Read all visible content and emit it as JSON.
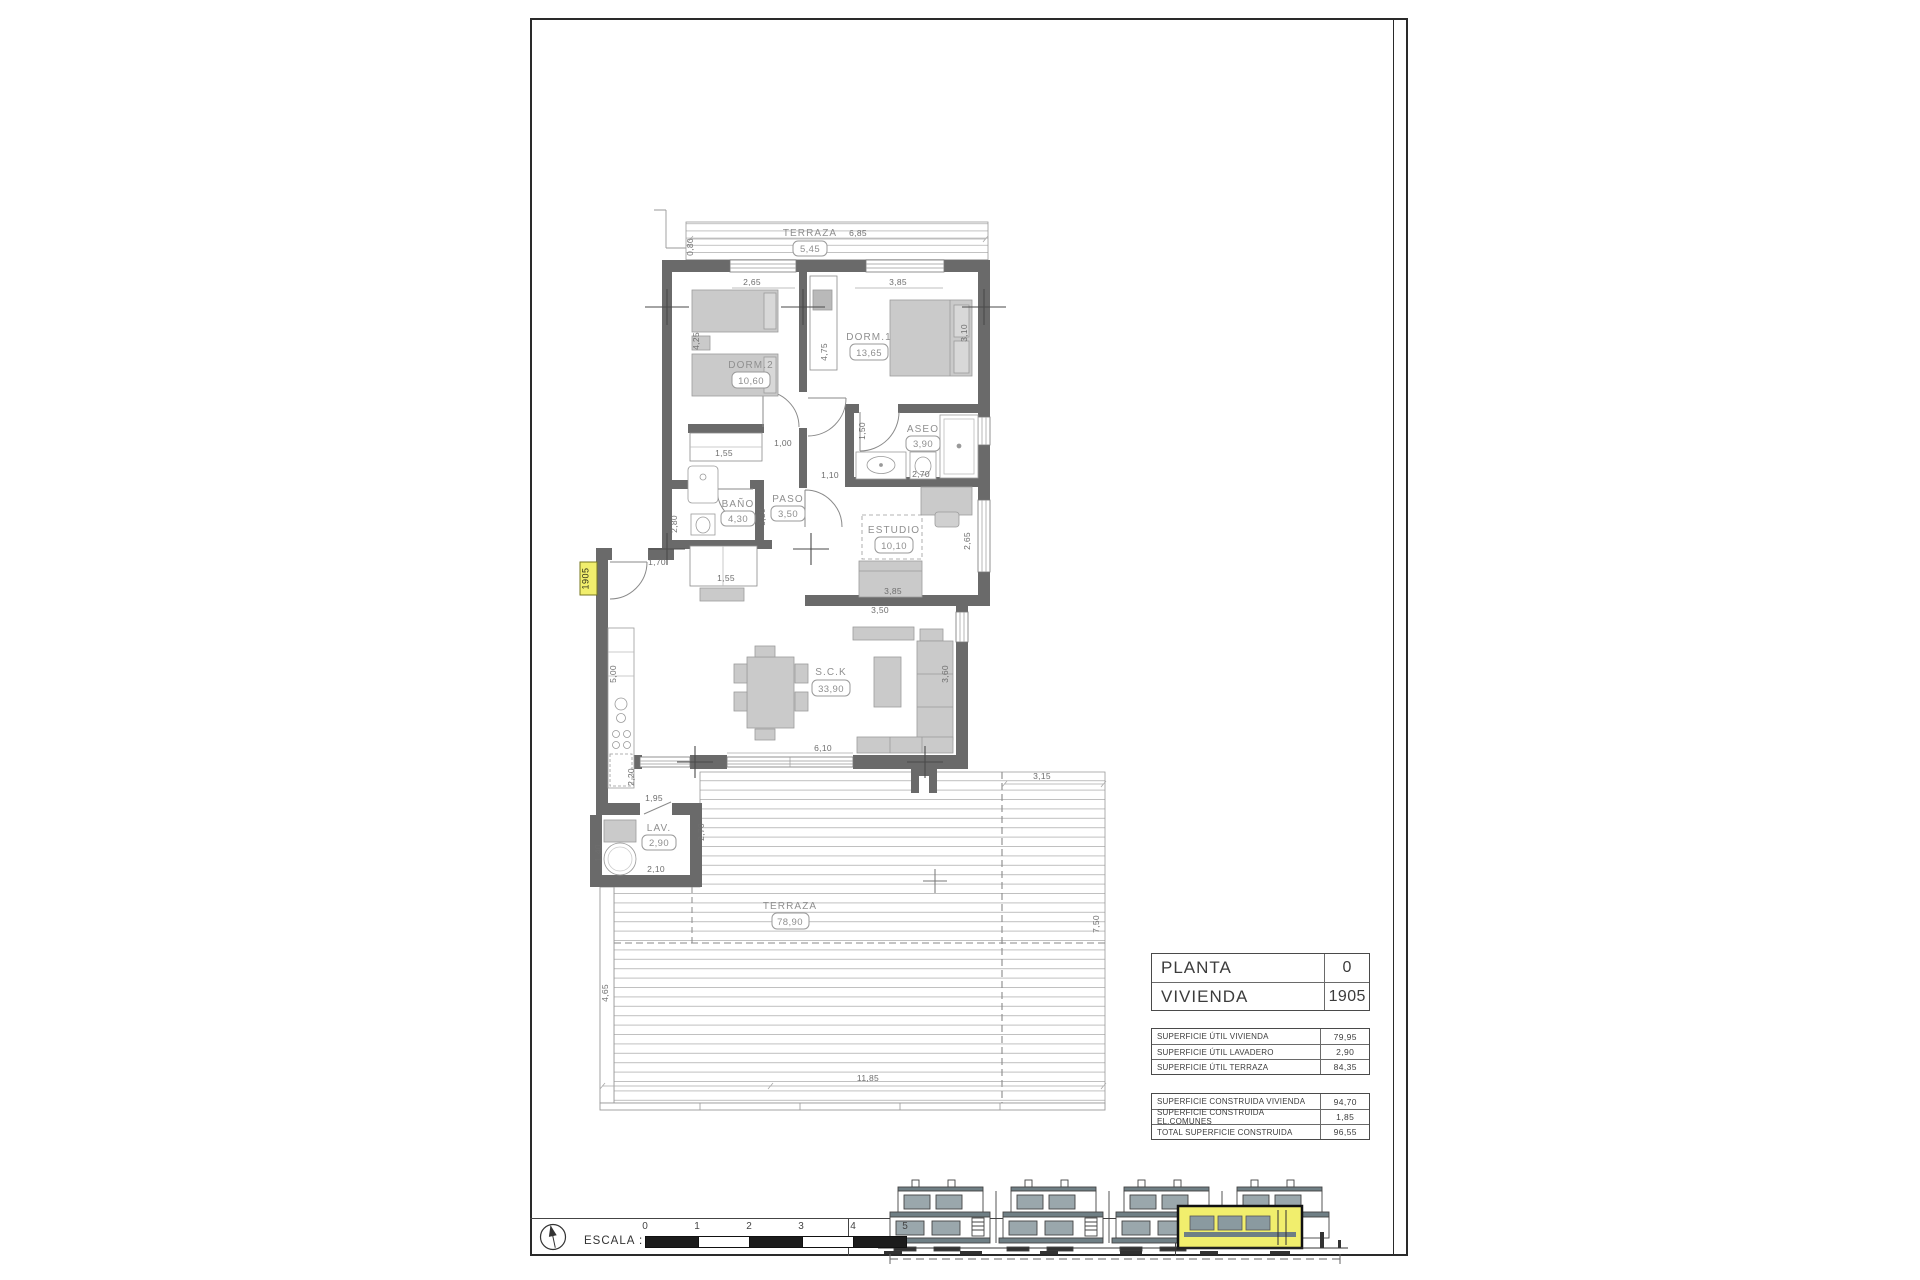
{
  "plan": {
    "unit_tag": "1905",
    "rooms": {
      "terraza_top": {
        "name": "TERRAZA",
        "area": "5,45"
      },
      "dorm2": {
        "name": "DORM.2",
        "area": "10,60"
      },
      "dorm1": {
        "name": "DORM.1",
        "area": "13,65"
      },
      "aseo": {
        "name": "ASEO",
        "area": "3,90"
      },
      "bano": {
        "name": "BAÑO",
        "area": "4,30"
      },
      "paso": {
        "name": "PASO",
        "area": "3,50"
      },
      "estudio": {
        "name": "ESTUDIO",
        "area": "10,10"
      },
      "sck": {
        "name": "S.C.K",
        "area": "33,90"
      },
      "lav": {
        "name": "LAV.",
        "area": "2,90"
      },
      "terraza": {
        "name": "TERRAZA",
        "area": "78,90"
      }
    },
    "dims": {
      "top_len": "6,85",
      "top_h": "0,80",
      "dorm2_w": "2,65",
      "dorm1_w": "3,85",
      "dorm2_h": "4,25",
      "hall_h": "4,75",
      "dorm1_h": "3,10",
      "closet1": "1,55",
      "corr1": "1,00",
      "corr2": "1,10",
      "aseo_door": "1,50",
      "aseo_w": "2,70",
      "bano_h": "2,80",
      "paso_h": "3,50",
      "closet2": "1,55",
      "entry": "1,70",
      "estudio_w": "3,85",
      "estudio_h": "2,65",
      "sofa_w": "3,50",
      "sofa_h": "3,60",
      "kitchen_h": "5,00",
      "win_w": "6,10",
      "pass_h": "2,20",
      "lav_top": "1,95",
      "lav_w": "2,10",
      "lav_h": "1,40",
      "lav_r": "2,70",
      "terr_top": "3,15",
      "terr_right": "7,50",
      "terr_left": "4,65",
      "terr_bottom": "11,85"
    }
  },
  "title_block": {
    "rows": [
      {
        "label": "PLANTA",
        "value": "0"
      },
      {
        "label": "VIVIENDA",
        "value": "1905"
      }
    ]
  },
  "area_tables": {
    "util": [
      {
        "label": "SUPERFICIE ÚTIL VIVIENDA",
        "value": "79,95"
      },
      {
        "label": "SUPERFICIE ÚTIL LAVADERO",
        "value": "2,90"
      },
      {
        "label": "SUPERFICIE ÚTIL TERRAZA",
        "value": "84,35"
      }
    ],
    "construida": [
      {
        "label": "SUPERFICIE CONSTRUIDA VIVIENDA",
        "value": "94,70"
      },
      {
        "label": "SUPERFICIE CONSTRUIDA EL.COMUNES",
        "value": "1,85"
      },
      {
        "label": "TOTAL SUPERFICIE CONSTRUIDA",
        "value": "96,55"
      }
    ]
  },
  "scale_bar": {
    "label": "ESCALA :",
    "ticks": [
      "0",
      "1",
      "2",
      "3",
      "4",
      "5"
    ]
  },
  "colors": {
    "wall": "#6a6a6a",
    "furniture": "#cacaca",
    "highlight": "#f1ee6d",
    "hatch": "#b4b4b4"
  }
}
